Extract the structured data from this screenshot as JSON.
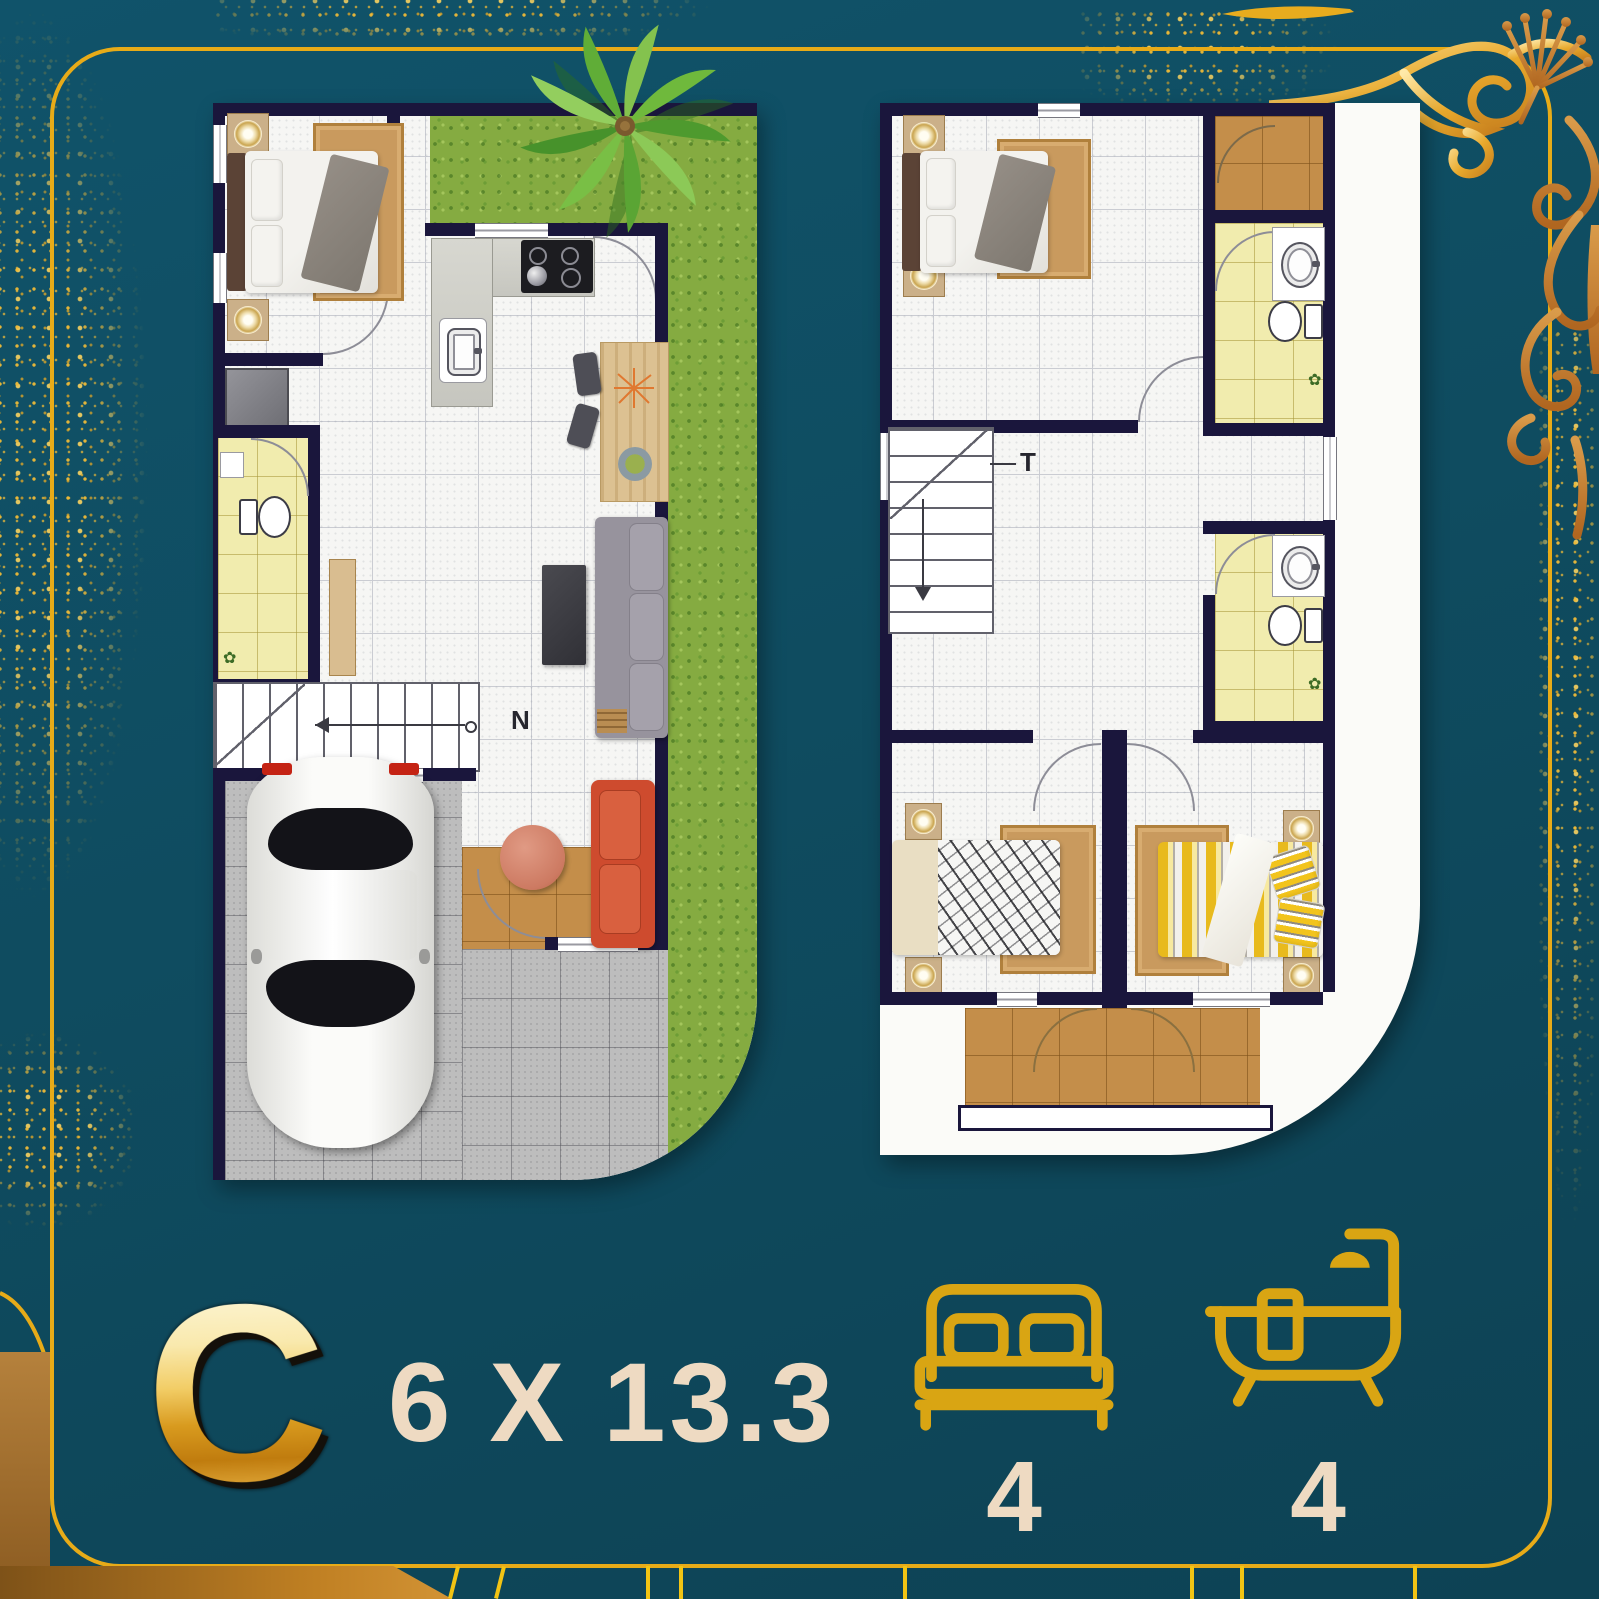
{
  "poster": {
    "unit_label": "C",
    "unit_dimensions": "6 X 13.3",
    "features": {
      "bedrooms": {
        "icon": "bed-icon",
        "count": "4"
      },
      "bathrooms": {
        "icon": "bathtub-icon",
        "count": "4"
      }
    },
    "floor_plans": {
      "ground_floor": {
        "name": "ground-floor-plan",
        "stair_annotation": "N"
      },
      "upper_floor": {
        "name": "upper-floor-plan",
        "stair_annotation": "T"
      }
    },
    "colors": {
      "background": "#0f4c60",
      "gold": "#e7ab18",
      "cream_text": "#eedac2",
      "wall_navy": "#1a163c",
      "grass_green": "#85ab41",
      "bathroom_yellow": "#f1ecae",
      "terrace_brown": "#c48e4a",
      "carport_gray": "#bdbdbd"
    }
  }
}
